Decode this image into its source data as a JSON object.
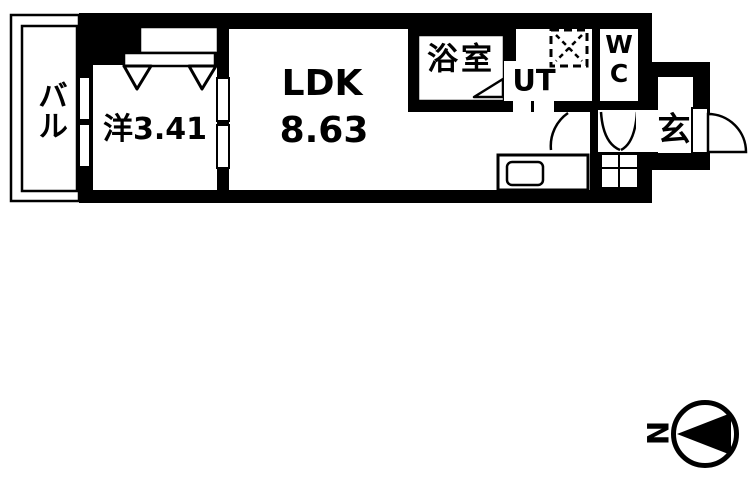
{
  "canvas": {
    "width": 750,
    "height": 480,
    "bg": "#ffffff",
    "ink": "#000000"
  },
  "floor_plan": {
    "rooms": [
      {
        "id": "balcony",
        "label": "バル"
      },
      {
        "id": "western_room",
        "label": "洋3.41"
      },
      {
        "id": "ldk",
        "label": "LDK",
        "area": "8.63"
      },
      {
        "id": "bathroom",
        "label": "浴室"
      },
      {
        "id": "utility",
        "label": "UT"
      },
      {
        "id": "toilet",
        "label": "WC"
      },
      {
        "id": "entrance",
        "label": "玄"
      }
    ],
    "fixtures": [
      {
        "id": "washing_machine_pan",
        "symbol": "dashed-box-with-x"
      },
      {
        "id": "kitchen_sink",
        "symbol": "rounded-rect"
      },
      {
        "id": "closet_doors",
        "symbol": "double-triangle"
      },
      {
        "id": "bath_door",
        "symbol": "triangle"
      }
    ],
    "compass": {
      "label": "N",
      "points": "left"
    }
  }
}
